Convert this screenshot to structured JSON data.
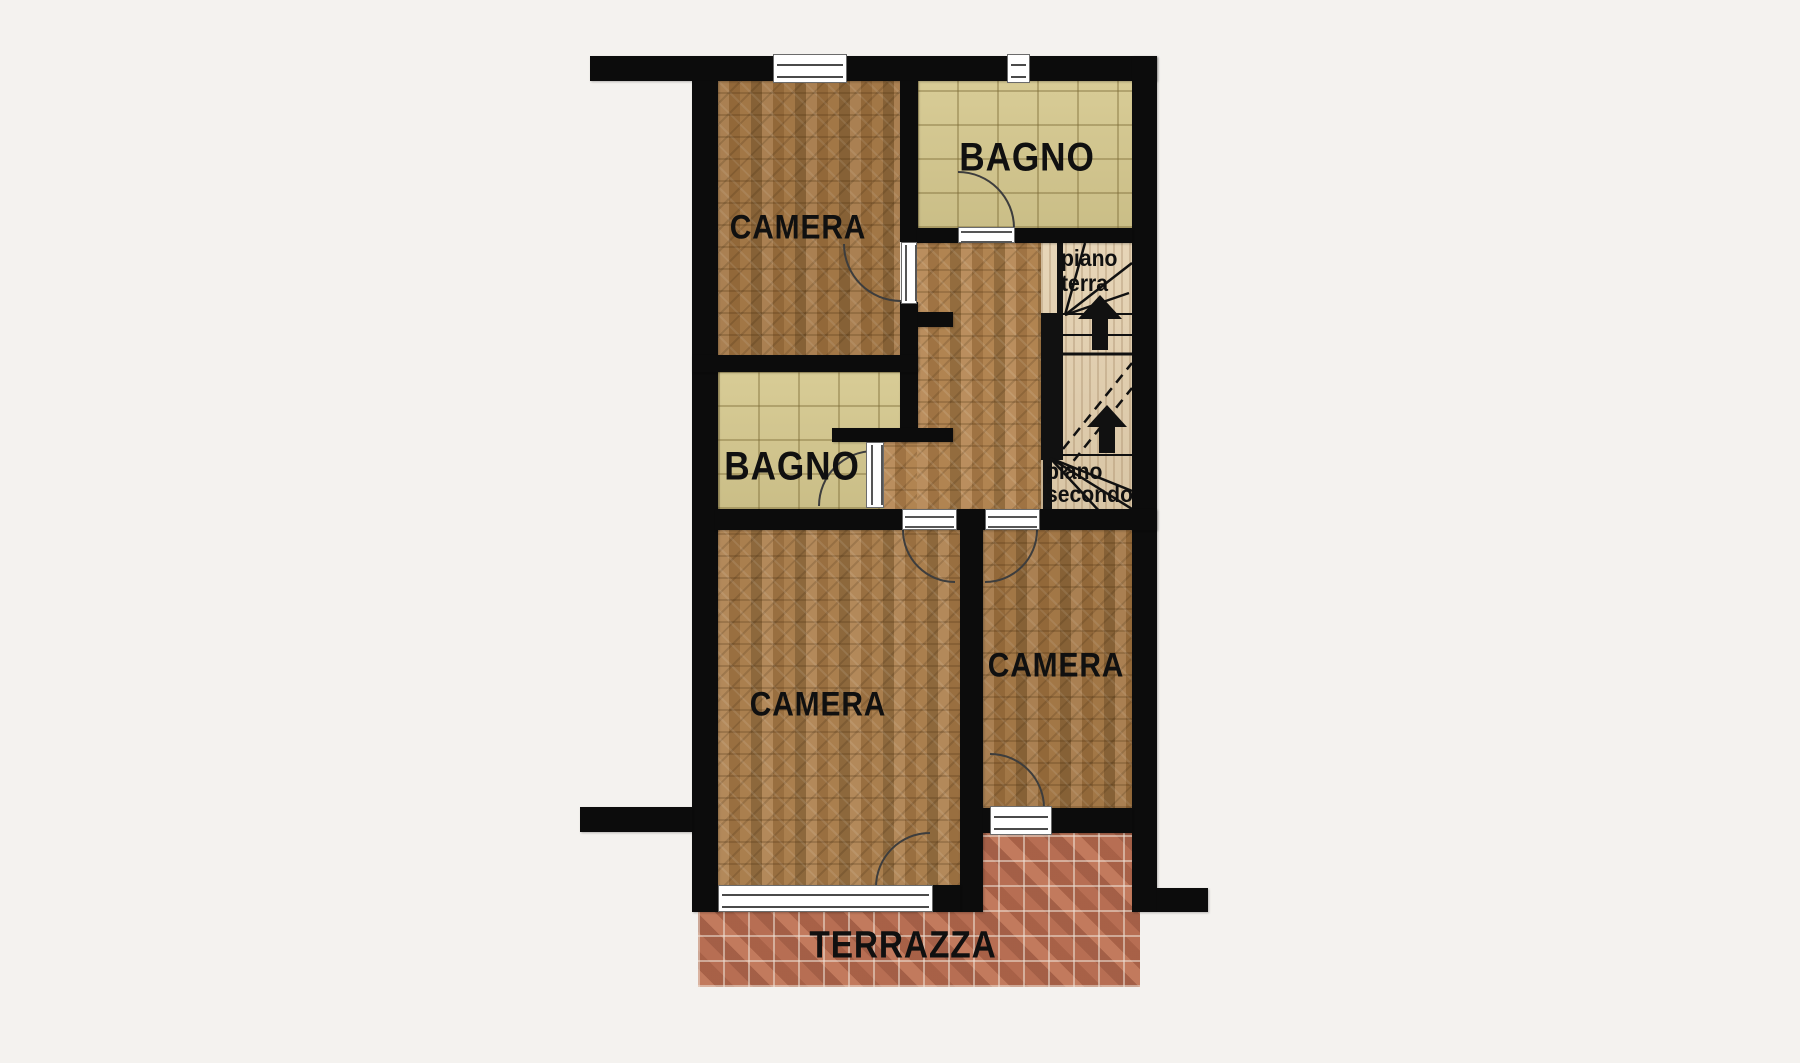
{
  "plan": {
    "type": "floor-plan",
    "language": "it",
    "rooms": {
      "camera_top": {
        "label": "CAMERA"
      },
      "bagno_top": {
        "label": "BAGNO"
      },
      "bagno_mid": {
        "label": "BAGNO"
      },
      "camera_bottom_left": {
        "label": "CAMERA"
      },
      "camera_bottom_right": {
        "label": "CAMERA"
      },
      "terrazza": {
        "label": "TERRAZZA"
      }
    },
    "stairs": {
      "flight_down_label": {
        "line1": "piano",
        "line2": "terra"
      },
      "flight_up_label": {
        "line1": "piano",
        "line2": "secondo"
      }
    },
    "colors": {
      "background": "#f4f2ef",
      "wall": "#0c0c0c",
      "parquet": "#a37c4c",
      "bagno_tile": "#d5c88e",
      "stair_wood": "#e4d0ae",
      "terrazza_brick": "#b26b51"
    }
  }
}
